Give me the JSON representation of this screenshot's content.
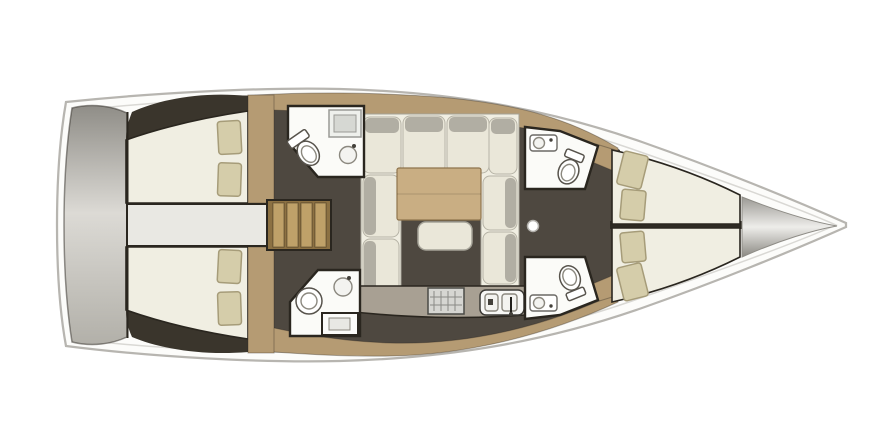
{
  "scene": {
    "type": "yacht-interior-floor-plan",
    "view": "top-down-deck-plan",
    "orientation": "bow-pointing-right",
    "background": "#ffffff"
  },
  "colors": {
    "hull_fill": "#fcfcfa",
    "hull_stroke": "#b7b5b0",
    "deck_line": "#d9d8d4",
    "floor_dark": "#4e4840",
    "floor_shadow": "#3a352c",
    "wood": "#b59b73",
    "stair_wood": "#8c7143",
    "stair_step": "#bfa169",
    "counter": "#a8a093",
    "engine_bay": "#e9e8e3",
    "cream": "#f0eee2",
    "cushion": "#eae7d9",
    "cushion_top": "#b1aea3",
    "pillow": "#d5cdaa",
    "pillow_border": "#a69c79",
    "room_white": "#fbfbf8",
    "wall": "#2a261f",
    "table_wood": "#c9ae83",
    "metal_top": "#8f8d87",
    "metal_mid": "#dcdad5",
    "metal_bottom": "#b2b0a9",
    "bow_edge": "#9b9994",
    "bow_center": "#eeedea",
    "bow_edge2": "#8b8983"
  },
  "components": {
    "hull": "monohull-sailboat-outline",
    "stern": "transom-swim-platform",
    "bow": "anchor-locker",
    "mast_foot": "mast-post",
    "rooms": [
      {
        "id": "aft-cabin-starboard",
        "type": "double-berth-cabin",
        "furniture": [
          "double-bed",
          "pillow",
          "pillow",
          "wardrobe"
        ]
      },
      {
        "id": "aft-cabin-port",
        "type": "double-berth-cabin",
        "furniture": [
          "double-bed",
          "pillow",
          "pillow",
          "wardrobe"
        ]
      },
      {
        "id": "engine-compartment",
        "type": "engine-bay",
        "furniture": []
      },
      {
        "id": "companionway",
        "type": "entry-stairs",
        "furniture": [
          "ladder-steps"
        ]
      },
      {
        "id": "aft-head-starboard",
        "type": "bathroom",
        "furniture": [
          "shower",
          "toilet",
          "washbasin"
        ]
      },
      {
        "id": "aft-head-port",
        "type": "bathroom",
        "furniture": [
          "toilet",
          "washbasin",
          "vanity-sink"
        ]
      },
      {
        "id": "saloon",
        "type": "salon",
        "furniture": [
          "u-shaped-sofa",
          "dining-table",
          "ottoman"
        ]
      },
      {
        "id": "galley",
        "type": "kitchen",
        "furniture": [
          "stove",
          "double-sink",
          "counter"
        ]
      },
      {
        "id": "forward-head-starboard",
        "type": "bathroom",
        "furniture": [
          "washbasin",
          "toilet"
        ]
      },
      {
        "id": "forward-head-port",
        "type": "bathroom",
        "furniture": [
          "toilet",
          "washbasin"
        ]
      },
      {
        "id": "forward-cabin-starboard",
        "type": "v-berth-cabin",
        "furniture": [
          "berth",
          "pillow",
          "pillow"
        ]
      },
      {
        "id": "forward-cabin-port",
        "type": "v-berth-cabin",
        "furniture": [
          "berth",
          "pillow",
          "pillow"
        ]
      }
    ]
  }
}
